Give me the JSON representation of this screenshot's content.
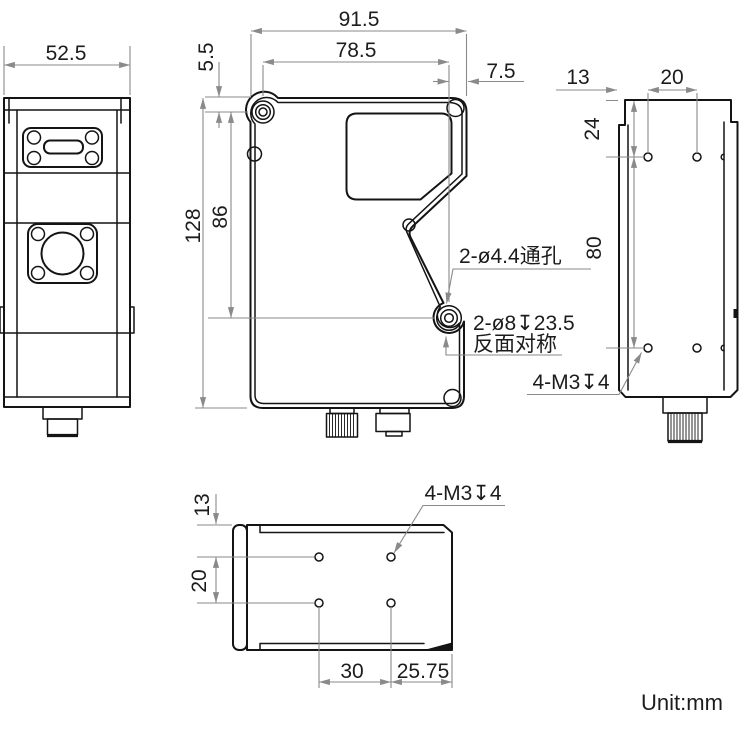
{
  "unit_label": "Unit:mm",
  "dims": {
    "left_width": "52.5",
    "front_width": "91.5",
    "front_hole_span": "78.5",
    "front_top_offset": "5.5",
    "front_right_offset": "7.5",
    "front_height": "128",
    "front_hole_height": "86",
    "right_left_offset": "13",
    "right_hole_span": "20",
    "right_top_offset": "24",
    "right_hole_height": "80",
    "bottom_top_offset": "13",
    "bottom_hole_span_v": "20",
    "bottom_hole_span_h": "30",
    "bottom_right_offset": "25.75"
  },
  "annotations": {
    "through_holes": "2-ø4.4通孔",
    "counterbore": "2-ø8↧23.5",
    "counterbore_note": "反面对称",
    "right_tapped": "4-M3↧4",
    "bottom_tapped": "4-M3↧4"
  },
  "colors": {
    "geometry_line": "#141414",
    "dimension_line": "#8a8a8a",
    "text": "#1c1c1c",
    "background": "#ffffff"
  }
}
